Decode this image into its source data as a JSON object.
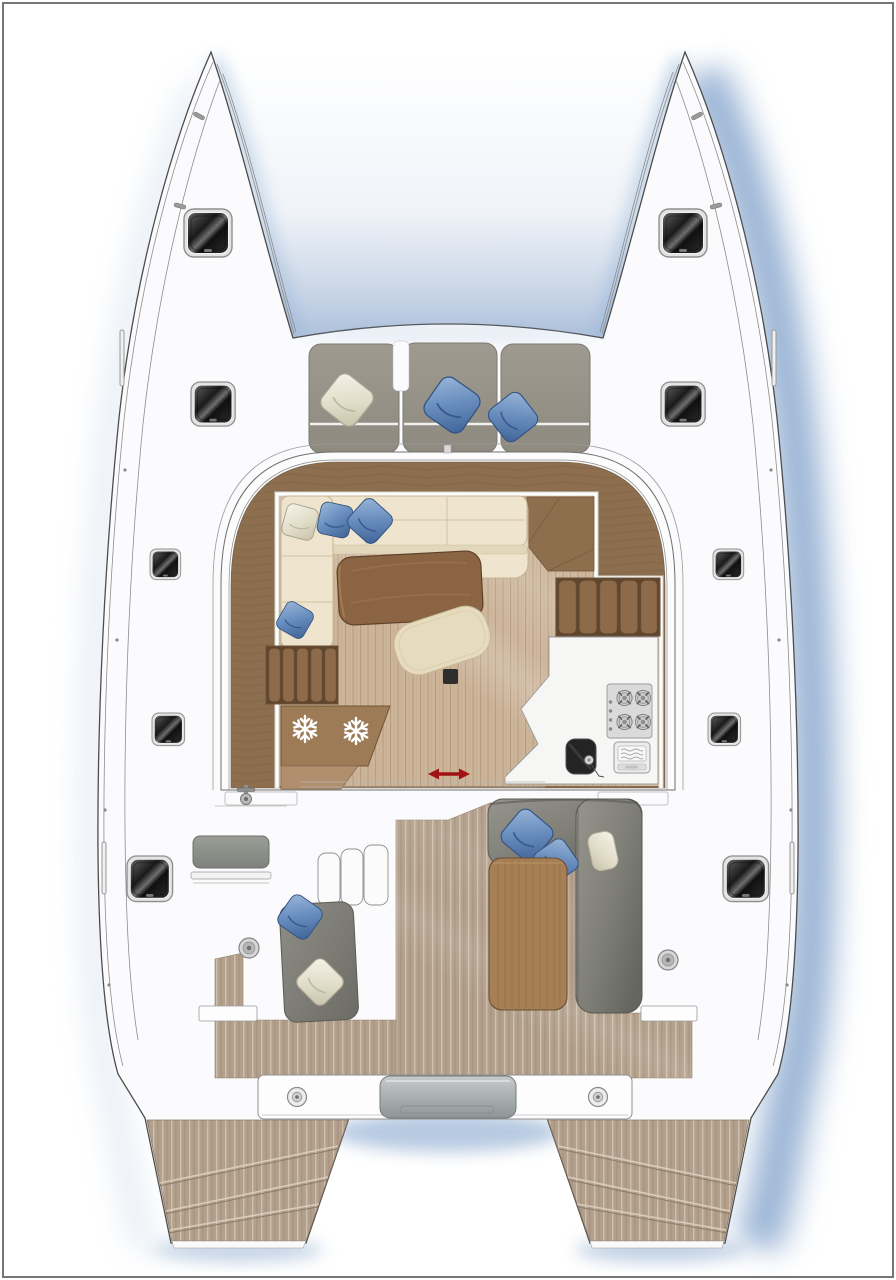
{
  "meta": {
    "title": "Catamaran deck plan",
    "type": "boat-floor-plan",
    "view": "top-down"
  },
  "palette": {
    "background": "#ffffff",
    "frame_border": "#767676",
    "hull_white": "#fbfbfd",
    "outline_gray": "#4d4d4d",
    "shadow_blue": "#7d9ec9",
    "hatch_dark": "#1c1c1c",
    "cushion_gray": "#99958c",
    "pillow_blue": "#6b90c0",
    "pillow_cream": "#eeebdd",
    "wood_dark_rim": "#8d6f50",
    "wood_floor_light": "#cdb59a",
    "sofa_cream": "#efe4cd",
    "table_walnut": "#8b6443",
    "ottoman_beige": "#e7dbbf",
    "cabinet_brown": "#9c7b56",
    "galley_white": "#f6f6f5",
    "steel_gray": "#dadada",
    "sink_black": "#242424",
    "cockpit_gray": "#85857e",
    "cockpit_table": "#a67f56",
    "teak_deck": "#b3a08c",
    "arrow_red": "#a31212"
  },
  "plan": {
    "vessel": "sailing catamaran",
    "areas": {
      "foredeck_lounge": {
        "cushion_sections": 3,
        "pillows": [
          "cream",
          "blue",
          "blue"
        ]
      },
      "salon": {
        "sofa": {
          "shape": "L",
          "color_key": "sofa_cream",
          "pillows": [
            "cream",
            "blue",
            "blue",
            "blue"
          ]
        },
        "dining_table": {
          "color_key": "table_walnut"
        },
        "ottoman": {
          "color_key": "ottoman_beige"
        },
        "refrigerator_drawers": {
          "count": 2,
          "icon": "snowflake-icon"
        },
        "louvered_cabinet": {
          "slats": 5
        },
        "companionway_steps": {
          "slats": 5
        },
        "galley": {
          "stove_burners": 4,
          "oven": 1,
          "sink": 1
        },
        "sliding_door_marker": {
          "icon": "double-arrow-icon",
          "color_key": "arrow_red"
        }
      },
      "cockpit": {
        "port": {
          "bench": 1,
          "step_panels": 3,
          "chaise_pillows": [
            "blue",
            "cream"
          ]
        },
        "starboard": {
          "sofa_pillows": [
            "blue",
            "blue",
            "cream"
          ],
          "table": 1
        },
        "deck_fittings": 2,
        "boarding_gates": 2,
        "windlass": 1
      },
      "stern": {
        "transom_beam": 1,
        "beam_fittings": 2,
        "center_pad": 1,
        "swim_step_flights": 2,
        "treads_per_flight": 3
      },
      "hatches": {
        "port_hull": 5,
        "starboard_hull": 5
      }
    }
  }
}
